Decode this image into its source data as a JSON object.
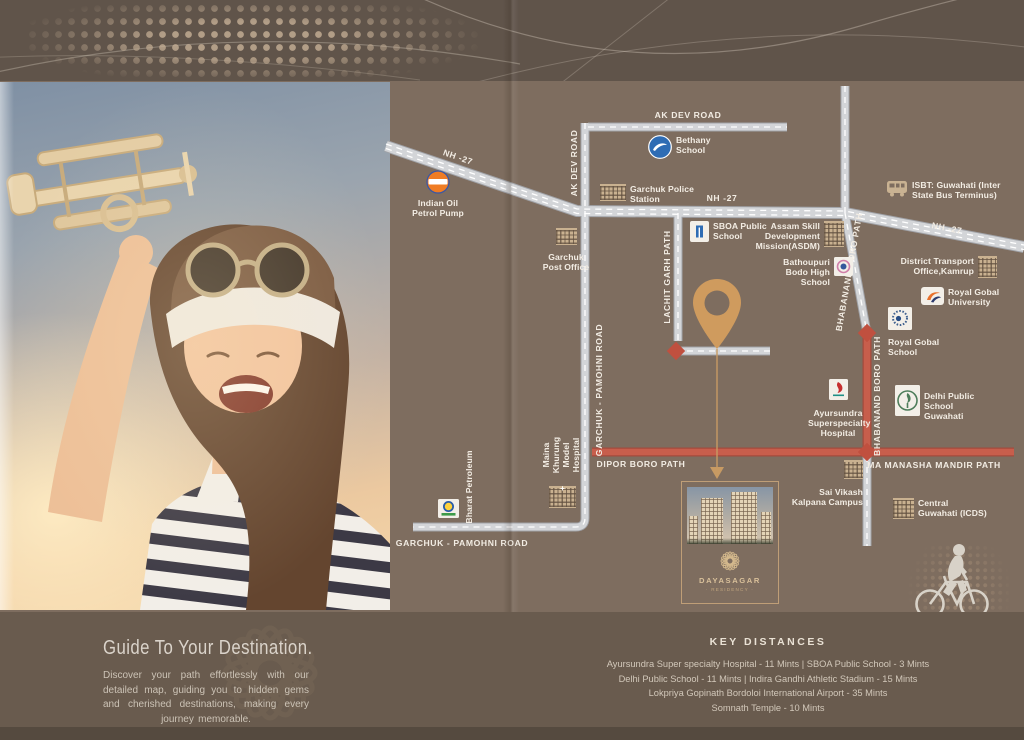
{
  "hero": {
    "heading": "Guide To Your Destination.",
    "body": "Discover your path effortlessly with our detailed map, guiding you to hidden gems and cherished destinations, making every journey memorable."
  },
  "brand": {
    "name": "DAYASAGAR",
    "tagline": "· RESIDENCY ·"
  },
  "map": {
    "roads": {
      "ak_dev_road": "AK DEV ROAD",
      "nh_27": "NH -27",
      "lachit_garh_path": "LACHIT GARH PATH",
      "garchuk_pamohni_road": "GARCHUK - PAMOHNI ROAD",
      "bhabanand_boro_path": "BHABANAND BORO PATH",
      "dipor_boro_path": "DIPOR BORO PATH",
      "ma_manasha_mandir_path": "MA MANASHA MANDIR PATH"
    },
    "landmarks": [
      {
        "id": "indian-oil",
        "label": "Indian Oil Petrol Pump"
      },
      {
        "id": "bethany-school",
        "label": "Bethany School"
      },
      {
        "id": "garchuk-police-station",
        "label": "Garchuk Police Station"
      },
      {
        "id": "garchuk-post-office",
        "label": "Garchuk Post Office"
      },
      {
        "id": "sboa-public-school",
        "label": "SBOA Public School"
      },
      {
        "id": "asdm",
        "label": "Assam Skill Development Mission(ASDM)"
      },
      {
        "id": "isbt-guwahati",
        "label": "ISBT: Guwahati (Inter State Bus Terminus)"
      },
      {
        "id": "bathoupuri-bodo-high-school",
        "label": "Bathoupuri Bodo High School"
      },
      {
        "id": "district-transport-office",
        "label": "District Transport Office,Kamrup"
      },
      {
        "id": "royal-gobal-university",
        "label": "Royal Gobal University"
      },
      {
        "id": "royal-gobal-school",
        "label": "Royal Gobal School"
      },
      {
        "id": "ayursundra-hospital",
        "label": "Ayursundra Superspecialty Hospital"
      },
      {
        "id": "delhi-public-school",
        "label": "Delhi Public School Guwahati"
      },
      {
        "id": "sai-vikash-kalpana-campus",
        "label": "Sai Vikash Kalpana Campus"
      },
      {
        "id": "central-guwahati-icds",
        "label": "Central Guwahati (ICDS)"
      },
      {
        "id": "maina-khurung-model-hospital",
        "label": "Maina Khurung Model Hospital"
      },
      {
        "id": "bharat-petroleum",
        "label": "Bharat Petroleum"
      }
    ]
  },
  "key_distances": {
    "heading": "KEY DISTANCES",
    "lines": [
      "Ayursundra Super specialty Hospital - 11 Mints   |   SBOA Public School - 3 Mints",
      "Delhi Public School - 11 Mints   |   Indira Gandhi Athletic Stadium - 15 Mints",
      "Lokpriya Gopinath Bordoloi International Airport - 35 Mints",
      "Somnath Temple - 10 Mints"
    ]
  },
  "colors": {
    "map_background": "#7e6d5f",
    "header_band": "#60544a",
    "footer_band": "#695b4e",
    "road_gray": "#d3d5d8",
    "road_red": "#c75e4c",
    "accent_tan": "#cf9b5e",
    "label_text": "#f3ede4"
  }
}
